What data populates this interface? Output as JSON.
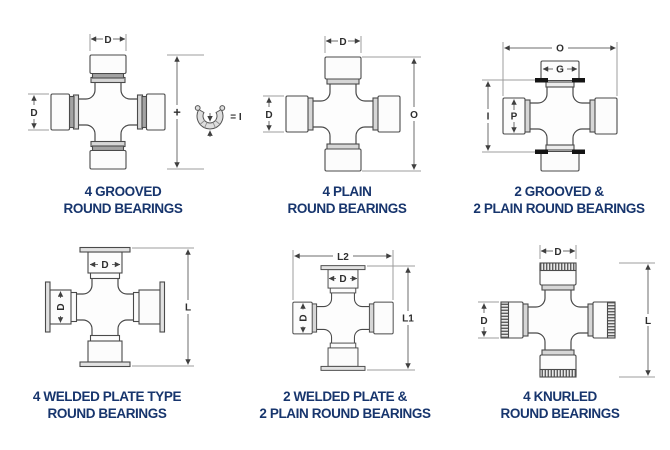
{
  "sheet": {
    "background": "#ffffff"
  },
  "colors": {
    "caption_navy": "#17356d",
    "part_outline": "#4a4a4a",
    "dimension_line": "#9c9c9c",
    "snap_ring_black": "#141414"
  },
  "diagrams": [
    {
      "id": "four-grooved-round-bearings",
      "caption_line1": "4 GROOVED",
      "caption_line2": "ROUND BEARINGS",
      "dims": {
        "top": "D",
        "left": "D",
        "plus": "+",
        "ring_equals": "= I"
      }
    },
    {
      "id": "four-plain-round-bearings",
      "caption_line1": "4 PLAIN",
      "caption_line2": "ROUND BEARINGS",
      "dims": {
        "top": "D",
        "left": "D",
        "right": "O"
      }
    },
    {
      "id": "two-grooved-two-plain-round-bearings",
      "caption_line1": "2 GROOVED &",
      "caption_line2": "2 PLAIN ROUND BEARINGS",
      "dims": {
        "top": "O",
        "cap_top": "G",
        "left": "I",
        "cap_left": "P"
      }
    },
    {
      "id": "four-welded-plate-type-round-bearings",
      "caption_line1": "4 WELDED PLATE TYPE",
      "caption_line2": "ROUND BEARINGS",
      "dims": {
        "cap_top": "D",
        "cap_left": "D",
        "right": "L"
      }
    },
    {
      "id": "two-welded-plate-two-plain-round-bearings",
      "caption_line1": "2 WELDED PLATE &",
      "caption_line2": "2 PLAIN ROUND BEARINGS",
      "dims": {
        "top": "L2",
        "cap_top": "D",
        "cap_left": "D",
        "right": "L1"
      }
    },
    {
      "id": "four-knurled-round-bearings",
      "caption_line1": "4 KNURLED",
      "caption_line2": "ROUND BEARINGS",
      "dims": {
        "top": "D",
        "left": "D",
        "right": "L"
      }
    }
  ]
}
